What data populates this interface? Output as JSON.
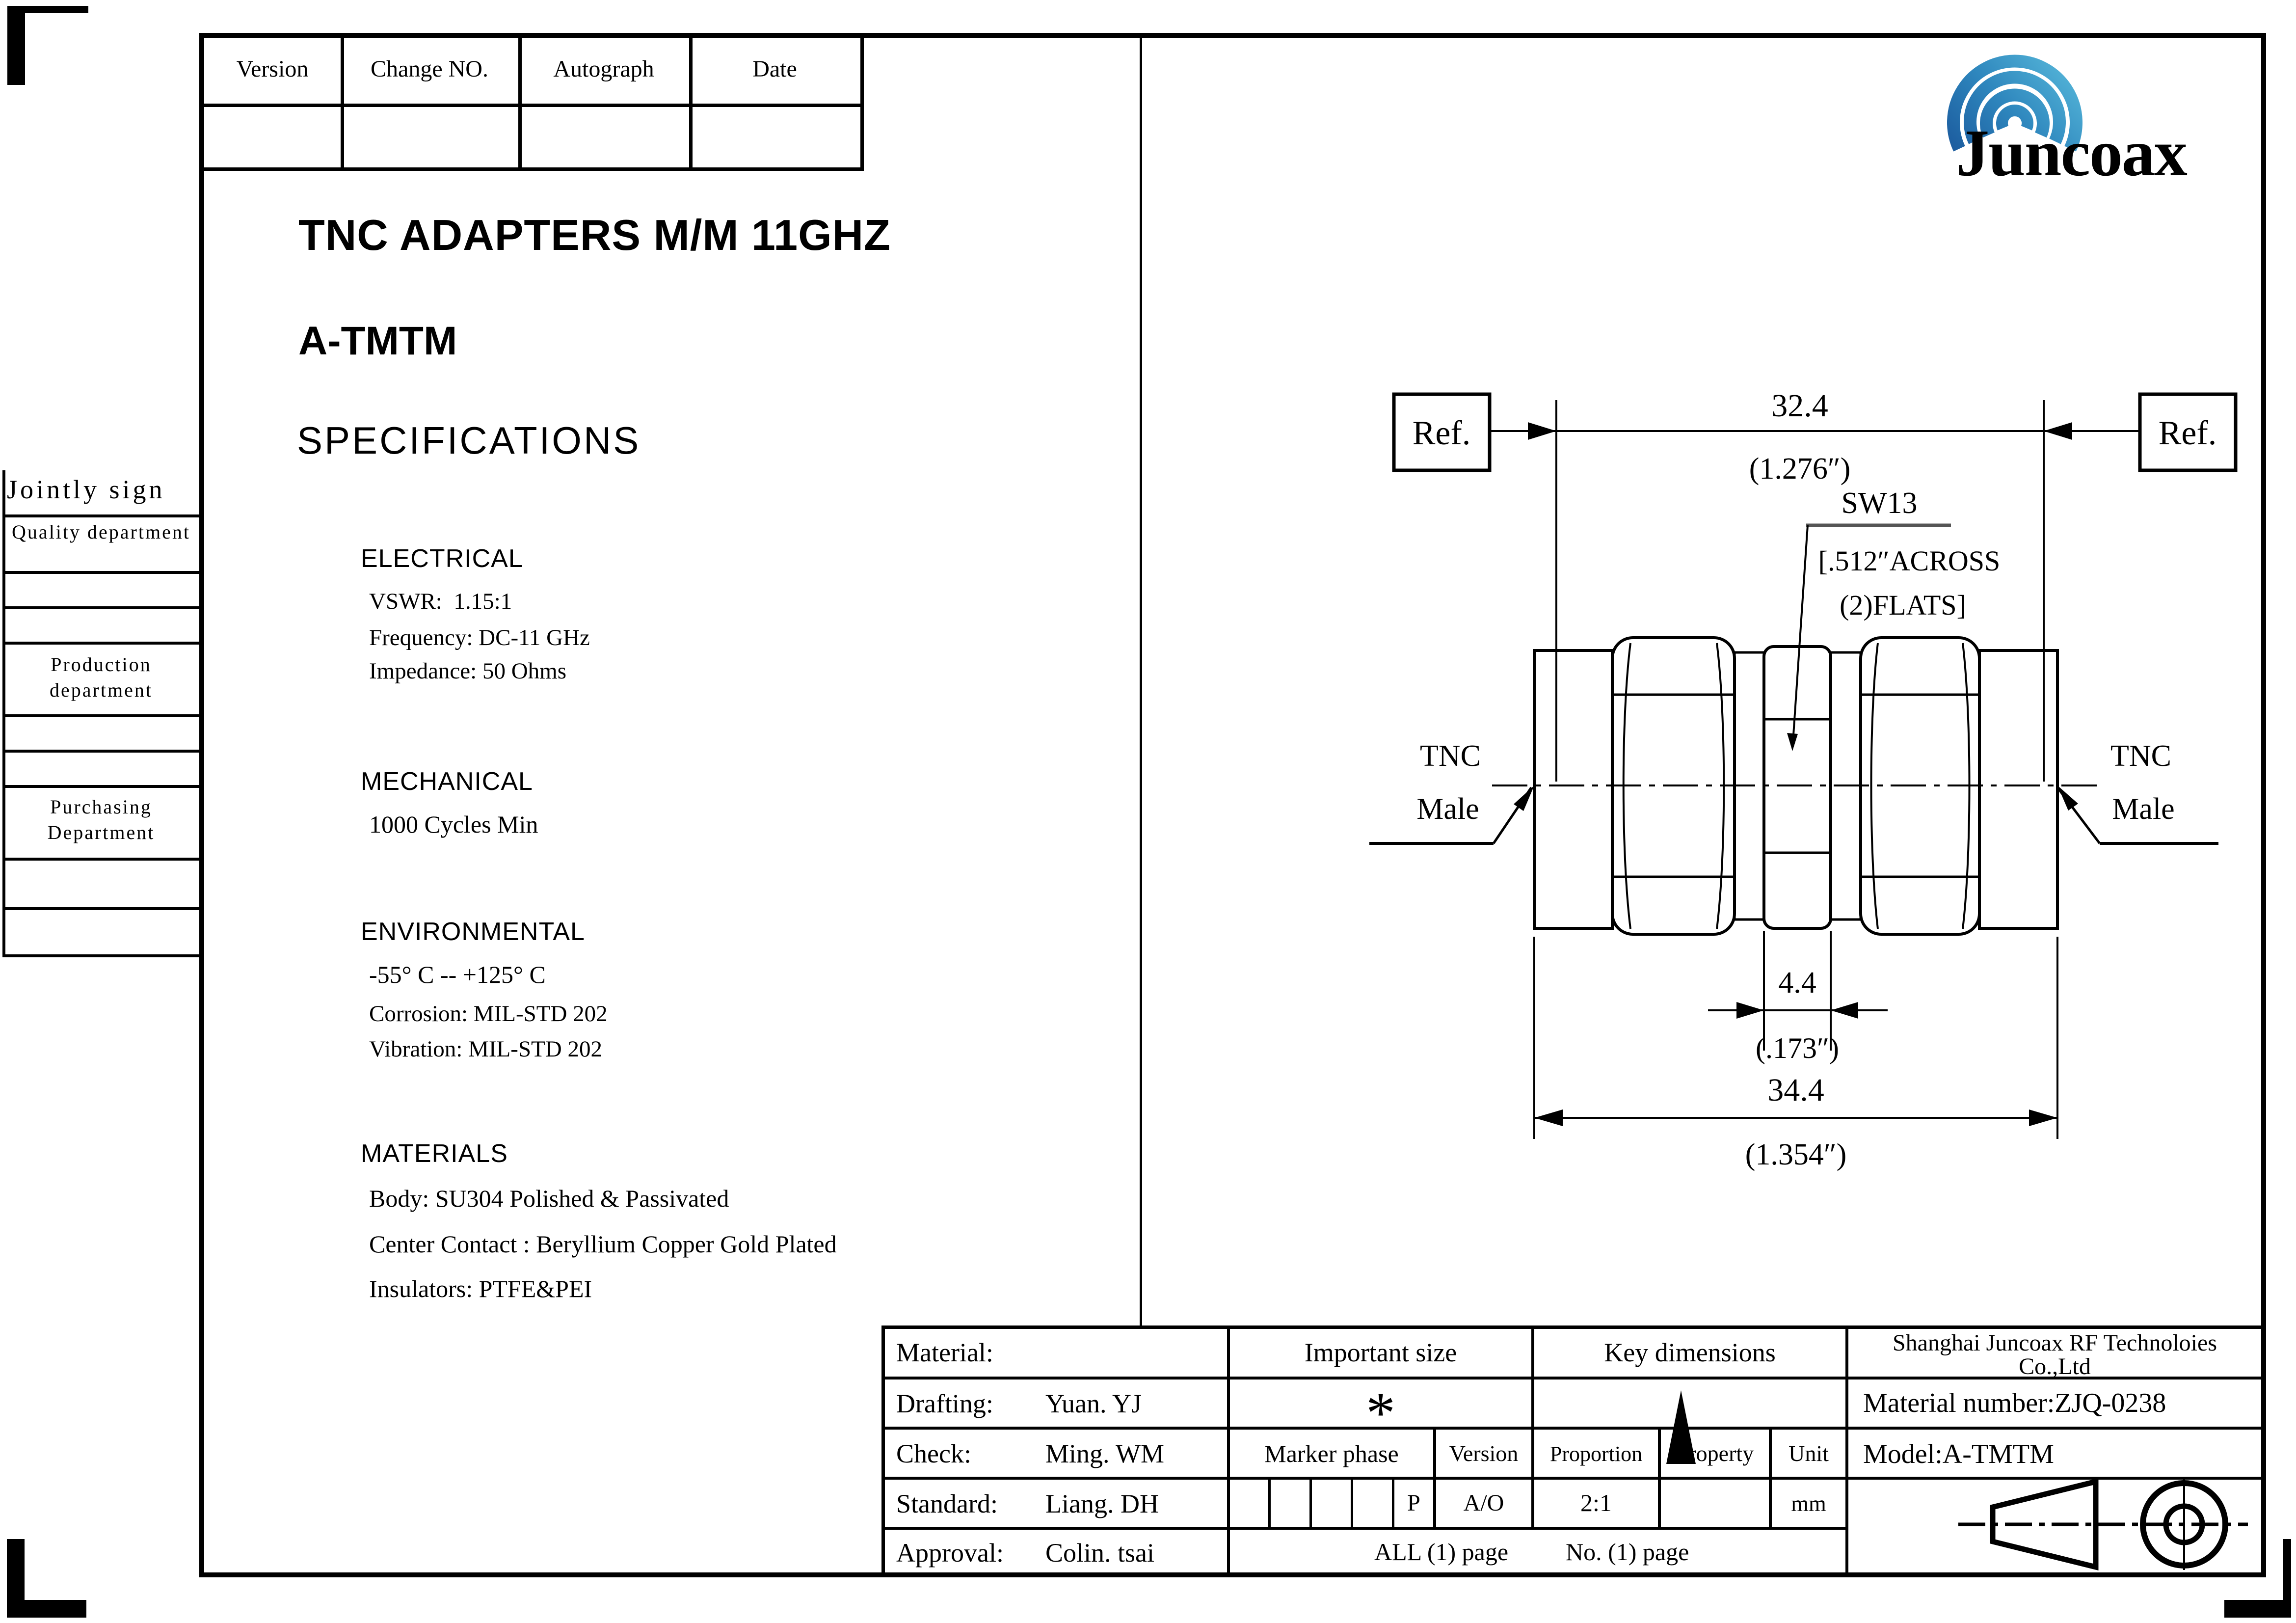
{
  "revision_table": {
    "headers": [
      "Version",
      "Change NO.",
      "Autograph",
      "Date"
    ]
  },
  "logo": {
    "text": "Juncoax",
    "text_color": "#1d60a8",
    "arc_dark": "#1a579b",
    "arc_mid": "#2e86bd",
    "arc_light": "#5fc2e0"
  },
  "doc": {
    "title": "TNC ADAPTERS M/M 11GHZ",
    "model_title": "A-TMTM",
    "section_title": "SPECIFICATIONS"
  },
  "specs": {
    "electrical": {
      "heading": "ELECTRICAL",
      "vswr": "VSWR:  1.15:1",
      "frequency": "Frequency: DC-11 GHz",
      "impedance": "Impedance: 50 Ohms"
    },
    "mechanical": {
      "heading": "MECHANICAL",
      "cycles": "1000 Cycles Min"
    },
    "environmental": {
      "heading": "ENVIRONMENTAL",
      "temperature": "-55° C -- +125° C",
      "corrosion": "Corrosion: MIL-STD 202",
      "vibration": "Vibration: MIL-STD 202"
    },
    "materials": {
      "heading": "MATERIALS",
      "body": "Body: SU304 Polished & Passivated",
      "center_contact": "Center Contact : Beryllium Copper Gold Plated",
      "insulators": "Insulators: PTFE&PEI"
    }
  },
  "sidebar": {
    "title": "Jointly sign",
    "rows": [
      "Quality department",
      "",
      "",
      "Production department",
      "",
      "",
      "Purchasing Department",
      "",
      ""
    ]
  },
  "drawing": {
    "ref_left": "Ref.",
    "ref_right": "Ref.",
    "dim_width": {
      "mm": "32.4",
      "inch": "(1.276″)"
    },
    "hex_label": {
      "line1": "SW13",
      "line2": "[.512″ACROSS",
      "line3": "(2)FLATS]"
    },
    "dim_hex": {
      "mm": "4.4",
      "inch": "(.173″)"
    },
    "dim_overall": {
      "mm": "34.4",
      "inch": "(1.354″)"
    },
    "left_connector": {
      "line1": "TNC",
      "line2": "Male"
    },
    "right_connector": {
      "line1": "TNC",
      "line2": "Male"
    }
  },
  "title_block": {
    "material_label": "Material:",
    "important_size": "Important size",
    "key_dimensions": "Key dimensions",
    "company_line1": "Shanghai Juncoax RF Technoloies",
    "company_line2": "Co.,Ltd",
    "drafting_label": "Drafting:",
    "drafting_value": "Yuan. YJ",
    "important_size_mark": "*",
    "material_number": "Material number:ZJQ-0238",
    "check_label": "Check:",
    "check_value": "Ming. WM",
    "marker_phase": "Marker phase",
    "version_label": "Version",
    "proportion_label": "Proportion",
    "property_label": "Property",
    "unit_label": "Unit",
    "model": "Model:A-TMTM",
    "standard_label": "Standard:",
    "standard_value": "Liang. DH",
    "phase_p": "P",
    "version_value": "A/O",
    "proportion_value": "2:1",
    "property_value": "",
    "unit_value": "mm",
    "approval_label": "Approval:",
    "approval_value": "Colin. tsai",
    "all_page": "ALL (1) page",
    "no_page": "No. (1) page"
  }
}
